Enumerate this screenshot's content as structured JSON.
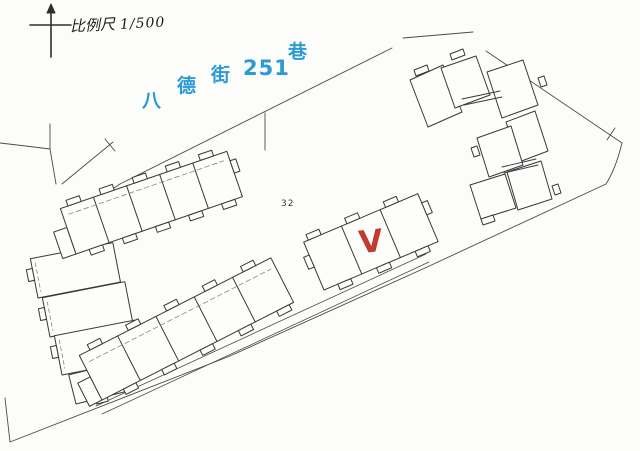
{
  "page": {
    "background": "#fcfcfa",
    "ink": "#383838",
    "title": "site plan scan"
  },
  "compass": {
    "icon": "north-arrow"
  },
  "scale": {
    "label": "比例尺",
    "ratio": "1/500"
  },
  "street": {
    "name": "八德街251巷",
    "color": "#2b9bd7",
    "chars": [
      "八",
      "德",
      "街",
      "251",
      "巷"
    ]
  },
  "lot": {
    "number": "32"
  },
  "mark": {
    "glyph": "V",
    "color": "#c23a30"
  }
}
